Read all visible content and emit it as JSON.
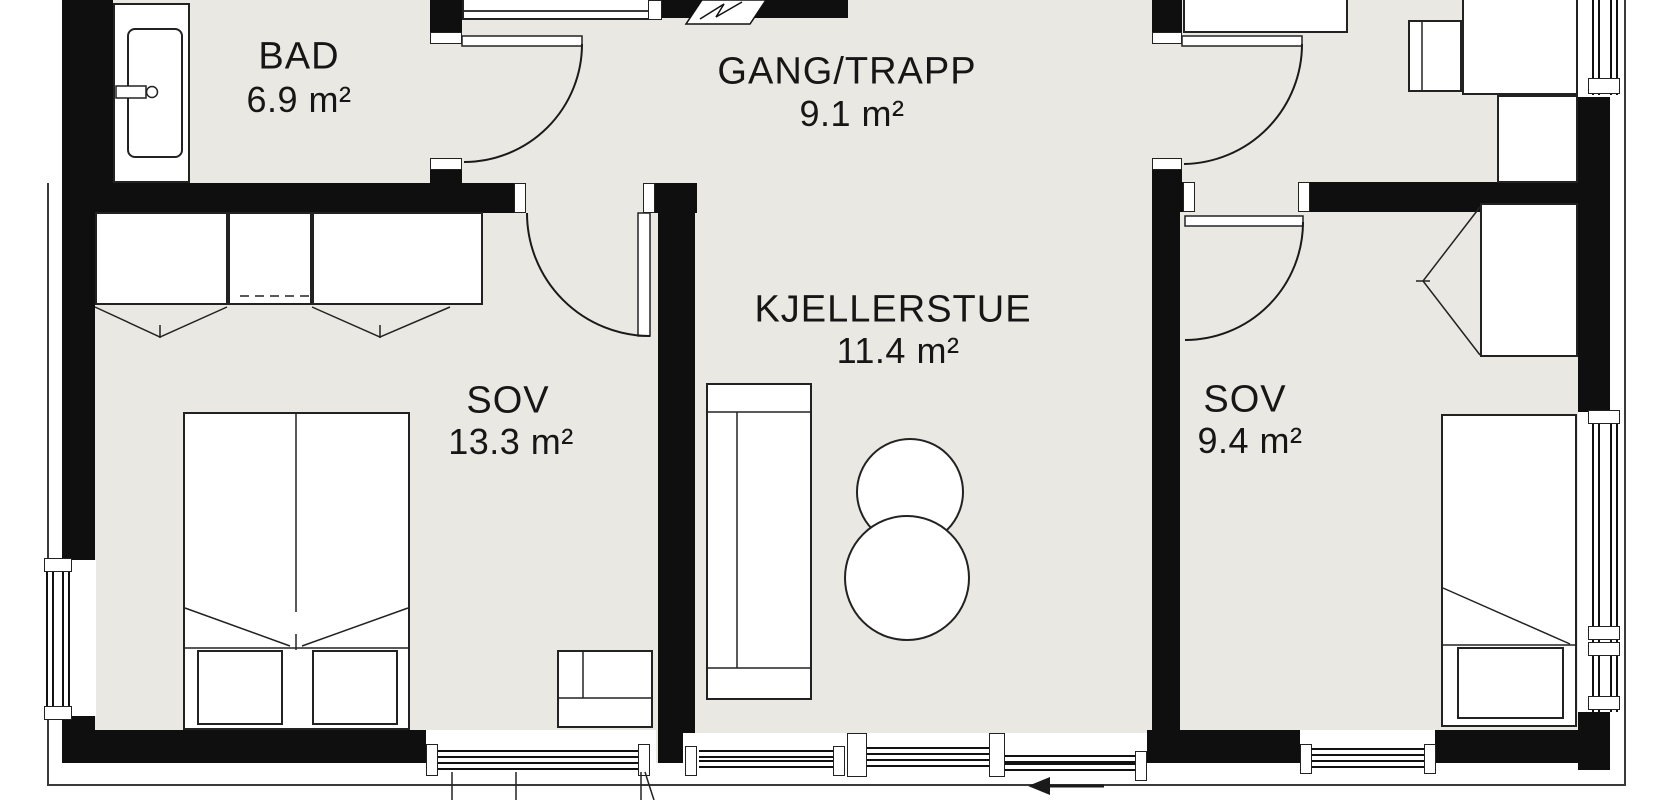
{
  "plan": {
    "type": "floor-plan",
    "rooms": [
      {
        "id": "bad",
        "label": "BAD",
        "area": "6.9 m²"
      },
      {
        "id": "gang-trapp",
        "label": "GANG/TRAPP",
        "area": "9.1 m²"
      },
      {
        "id": "kjellerstue",
        "label": "KJELLERSTUE",
        "area": "11.4 m²"
      },
      {
        "id": "sov-left",
        "label": "SOV",
        "area": "13.3 m²"
      },
      {
        "id": "sov-right",
        "label": "SOV",
        "area": "9.4 m²"
      }
    ],
    "entrance_arrow": {
      "direction": "left"
    },
    "colors": {
      "floor": "#e9e8e3",
      "wall": "#0f0f0f",
      "furniture_line": "#222222",
      "background": "#ffffff",
      "text": "#161616"
    }
  }
}
